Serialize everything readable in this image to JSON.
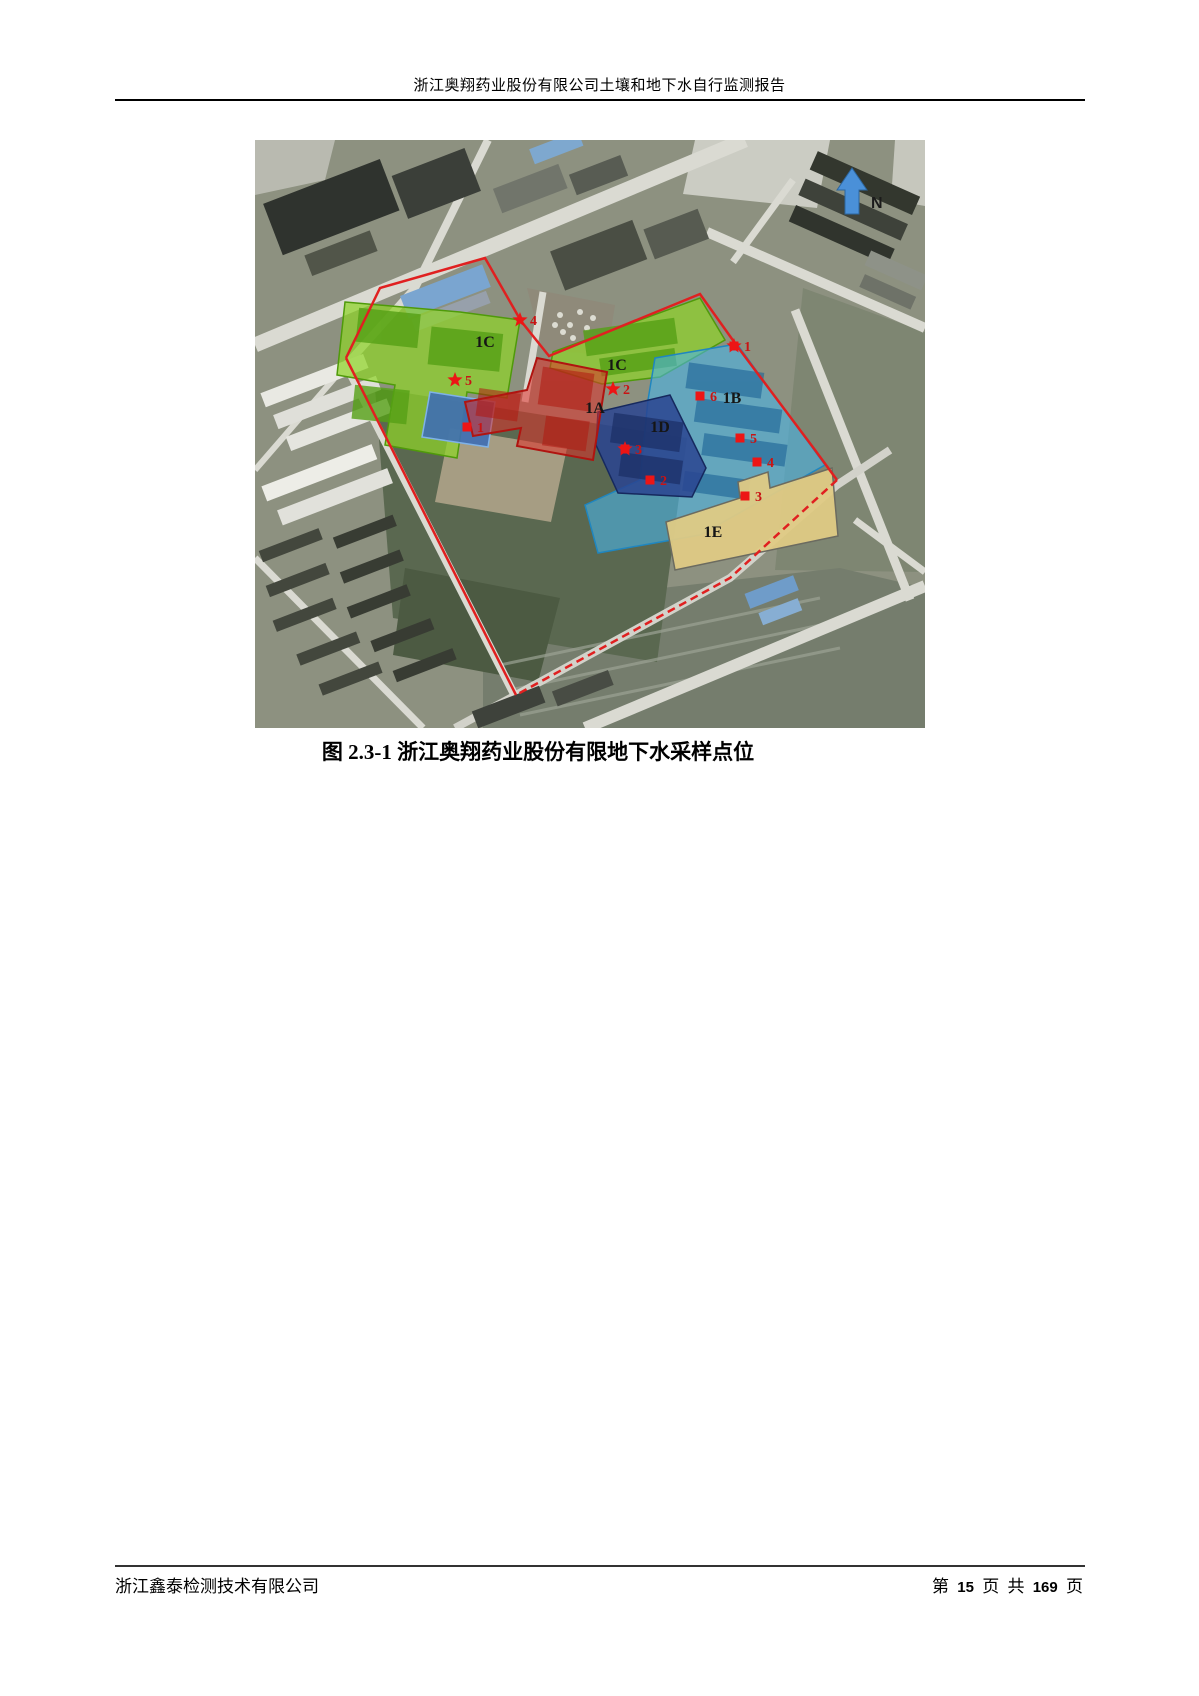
{
  "page": {
    "header_title": "浙江奥翔药业股份有限公司土壤和地下水自行监测报告",
    "figure_caption": "图 2.3-1 浙江奥翔药业股份有限地下水采样点位",
    "footer_company": "浙江鑫泰检测技术有限公司",
    "footer_page": {
      "prefix": "第",
      "current": "15",
      "unit1": "页",
      "conj": "共",
      "total": "169",
      "unit2": "页"
    }
  },
  "map": {
    "north_label": "N",
    "boundary_color": "#e02020",
    "marker_color": "#ed1515",
    "marker_label_color": "#c81414",
    "zones": [
      {
        "id": "1A",
        "color": "#e03028",
        "stroke": "#b01410"
      },
      {
        "id": "1B",
        "color": "#4ab4e6",
        "stroke": "#1f86c0"
      },
      {
        "id": "1C",
        "color": "#8fd428",
        "stroke": "#4f9a0a"
      },
      {
        "id": "1D",
        "color": "#2a4490",
        "stroke": "#16295e"
      },
      {
        "id": "1E",
        "color": "#dfca84",
        "stroke": "#6b6b60"
      }
    ],
    "zone_labels": [
      {
        "text": "1C",
        "x": 230,
        "y": 207
      },
      {
        "text": "1C",
        "x": 362,
        "y": 230
      },
      {
        "text": "1A",
        "x": 340,
        "y": 273
      },
      {
        "text": "1D",
        "x": 405,
        "y": 292
      },
      {
        "text": "1B",
        "x": 477,
        "y": 263
      },
      {
        "text": "1E",
        "x": 458,
        "y": 397
      }
    ],
    "markers": [
      {
        "shape": "star-square",
        "label": "1",
        "x": 479,
        "y": 206
      },
      {
        "shape": "star",
        "label": "2",
        "x": 358,
        "y": 249
      },
      {
        "shape": "star-square",
        "label": "3",
        "x": 370,
        "y": 309
      },
      {
        "shape": "star",
        "label": "4",
        "x": 265,
        "y": 180
      },
      {
        "shape": "star",
        "label": "5",
        "x": 200,
        "y": 240
      },
      {
        "shape": "square",
        "label": "1",
        "x": 212,
        "y": 287
      },
      {
        "shape": "square",
        "label": "2",
        "x": 395,
        "y": 340
      },
      {
        "shape": "square",
        "label": "3",
        "x": 490,
        "y": 356
      },
      {
        "shape": "square",
        "label": "4",
        "x": 502,
        "y": 322
      },
      {
        "shape": "square",
        "label": "5",
        "x": 485,
        "y": 298
      },
      {
        "shape": "square",
        "label": "6",
        "x": 445,
        "y": 256
      }
    ]
  }
}
